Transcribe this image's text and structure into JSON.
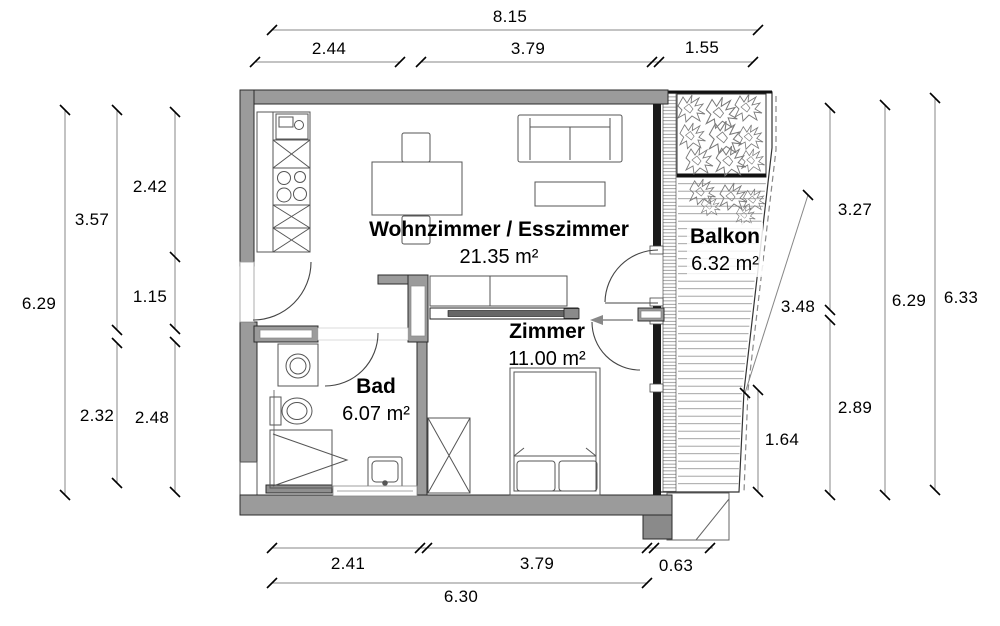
{
  "rooms": {
    "living": {
      "name": "Wohnzimmer / Esszimmer",
      "area": "21.35 m²"
    },
    "balcony": {
      "name": "Balkon",
      "area": "6.32 m²"
    },
    "bedroom": {
      "name": "Zimmer",
      "area": "11.00 m²"
    },
    "bathroom": {
      "name": "Bad",
      "area": "6.07 m²"
    }
  },
  "dimensions": {
    "top": {
      "total": "8.15",
      "seg1": "2.44",
      "seg2": "3.79",
      "seg3": "1.55"
    },
    "bottom": {
      "seg1": "2.41",
      "seg2": "3.79",
      "seg3": "0.63",
      "total": "6.30"
    },
    "left": {
      "overall": "6.29",
      "mid_upper": "3.57",
      "mid_lower": "2.32",
      "inner_upper": "2.42",
      "inner_mid": "1.15",
      "inner_lower": "2.48"
    },
    "right": {
      "balcony_slope": "3.48",
      "balcony_edge": "1.64",
      "inner_upper": "3.27",
      "inner_lower": "2.89",
      "overall_inner": "6.29",
      "overall_outer": "6.33"
    }
  },
  "colors": {
    "wall_fill": "#9b9b9b",
    "wall_dark": "#1a1a1a",
    "dim_line": "#878787",
    "furniture_line": "#555555",
    "text": "#000000",
    "background": "#ffffff"
  }
}
